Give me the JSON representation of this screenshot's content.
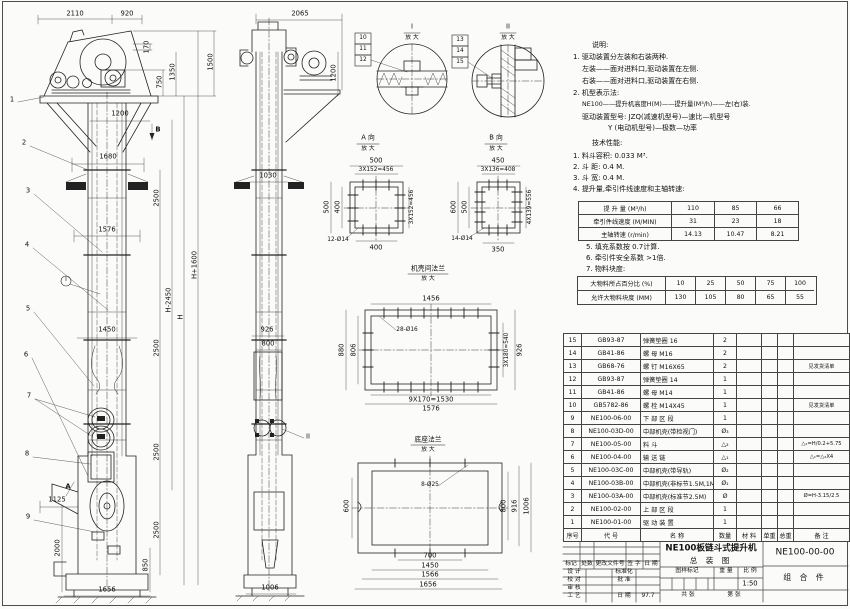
{
  "notes": {
    "heading": "说明:",
    "lines": [
      "1. 驱动装置分左装和右装两种.",
      "左装——面对进料口,驱动装置在左侧.",
      "右装——面对进料口,驱动装置在右侧.",
      "2. 机型表示法:",
      "NE100——提升机高度H(M)——提升量(M³/h)——左(右)装.",
      "驱动装置型号: JZQ(减速机型号)—速比—机型号",
      "Y (电动机型号)—极数—功率"
    ]
  },
  "tech": {
    "heading": "技术性能:",
    "items": [
      "1. 料斗容积: 0.033 M³.",
      "2. 斗  距: 0.4 M.",
      "3. 斗  宽: 0.4 M.",
      "4. 提升量,牵引件线速度和主轴转速:"
    ],
    "items2": [
      "5. 填充系数按 0.7计算.",
      "6. 牵引件安全系数 >1倍.",
      "7. 物料块度:"
    ]
  },
  "spec": {
    "rows": [
      {
        "label": "提 升 量 (M³/h)",
        "v1": "110",
        "v2": "85",
        "v3": "66"
      },
      {
        "label": "牵引件线速度 (M/MIN)",
        "v1": "31",
        "v2": "23",
        "v3": "18"
      },
      {
        "label": "主轴转速 (r/min)",
        "v1": "14.13",
        "v2": "10.47",
        "v3": "8.21"
      }
    ]
  },
  "lump": {
    "rows": [
      {
        "label": "大物料所占百分比 (%)",
        "c1": "10",
        "c2": "25",
        "c3": "50",
        "c4": "75",
        "c5": "100"
      },
      {
        "label": "允许大物料块度 (MM)",
        "c1": "130",
        "c2": "105",
        "c3": "80",
        "c4": "65",
        "c5": "55"
      }
    ]
  },
  "bom": {
    "headers": [
      "序号",
      "代  号",
      "名  称",
      "数量",
      "材  料",
      "单重",
      "总重",
      "备  注"
    ],
    "rows": [
      {
        "no": "15",
        "code": "GB93-87",
        "name": "弹簧垫圈 16",
        "qty": "2",
        "rem": ""
      },
      {
        "no": "14",
        "code": "GB41-86",
        "name": "螺 母 M16",
        "qty": "2",
        "rem": ""
      },
      {
        "no": "13",
        "code": "GB68-76",
        "name": "螺 钉 M16X65",
        "qty": "2",
        "rem": "见发货清单"
      },
      {
        "no": "12",
        "code": "GB93-87",
        "name": "弹簧垫圈 14",
        "qty": "1",
        "rem": ""
      },
      {
        "no": "11",
        "code": "GB41-86",
        "name": "螺 母 M14",
        "qty": "1",
        "rem": ""
      },
      {
        "no": "10",
        "code": "GB5782-86",
        "name": "螺 栓 M14X45",
        "qty": "1",
        "rem": "见发货清单"
      },
      {
        "no": "9",
        "code": "NE100-06-00",
        "name": "下 部 区 段",
        "qty": "1",
        "rem": ""
      },
      {
        "no": "8",
        "code": "NE100-03D-00",
        "name": "中部机壳(带检视门)",
        "qty": "Ø₃",
        "rem": ""
      },
      {
        "no": "7",
        "code": "NE100-05-00",
        "name": "料 斗",
        "qty": "△₂",
        "rem": "△₂=H/0.2+5.75"
      },
      {
        "no": "6",
        "code": "NE100-04-00",
        "name": "输 送 链",
        "qty": "△₁",
        "rem": "△₁=△₂X4"
      },
      {
        "no": "5",
        "code": "NE100-03C-00",
        "name": "中部机壳(带导轨)",
        "qty": "Ø₂",
        "rem": ""
      },
      {
        "no": "4",
        "code": "NE100-03B-00",
        "name": "中部机壳(非标节1.5M,1M)",
        "qty": "Ø₁",
        "rem": ""
      },
      {
        "no": "3",
        "code": "NE100-03A-00",
        "name": "中部机壳(标准节2.5M)",
        "qty": "Ø",
        "rem": "Ø=H-3.15/2.5"
      },
      {
        "no": "2",
        "code": "NE100-02-00",
        "name": "上 部 区 段",
        "qty": "1",
        "rem": ""
      },
      {
        "no": "1",
        "code": "NE100-01-00",
        "name": "驱 动 装 置",
        "qty": "1",
        "rem": ""
      }
    ]
  },
  "tb": {
    "title1": "NE100板链斗式提升机",
    "title2": "总  装  图",
    "dwg_no": "NE100-00-00",
    "part": "组 合 件",
    "rev": [
      "标记",
      "处数",
      "更改文件号",
      "签 字",
      "日 期"
    ],
    "design": "设 计",
    "std": "标准化",
    "check": "校 对",
    "approve": "批 准",
    "audit": "审 核",
    "craft": "工 艺",
    "date_lbl": "日 期",
    "date": "97.7",
    "mark": "图样标记",
    "weight": "重 量",
    "scale_lbl": "比 例",
    "scale": "1:50",
    "sheets": "共  张",
    "page": "第  张"
  },
  "fv": {
    "d2110": "2110",
    "d920": "920",
    "d170": "170",
    "d750": "750",
    "d1350": "1350",
    "d1500": "1500",
    "d1200": "1200",
    "d1680": "1680",
    "d1576": "1576",
    "d1450": "1450",
    "d1125": "1125",
    "d2000": "2000",
    "d850": "850",
    "d1656": "1656",
    "d2500a": "2500",
    "d2500b": "2500",
    "d2500c": "2500",
    "d2500d": "2500",
    "dH1600": "H+1600",
    "dH2450": "H-2450",
    "dH": "H",
    "mA": "A",
    "mB": "B",
    "mI": "I"
  },
  "sv": {
    "d2065": "2065",
    "d1200": "1200",
    "d1030": "1030",
    "d926": "926",
    "d800": "800",
    "d1006": "1006",
    "mII": "II"
  },
  "co": {
    "c1": "1",
    "c2": "2",
    "c3": "3",
    "c4": "4",
    "c5": "5",
    "c6": "6",
    "c7": "7",
    "c8": "8",
    "c9": "9"
  },
  "di": {
    "title": "I",
    "sub": "放 大",
    "c10": "10",
    "c11": "11",
    "c12": "12"
  },
  "dii": {
    "title": "II",
    "sub": "放 大",
    "c13": "13",
    "c14": "14",
    "c15": "15"
  },
  "da": {
    "title": "A 向",
    "sub": "放 大",
    "t1": "500",
    "t2": "3X152=456",
    "l1": "500",
    "l2": "400",
    "r1": "3X152=456",
    "b1": "400",
    "holes": "12-Ø14"
  },
  "db": {
    "title": "B 向",
    "sub": "放 大",
    "t1": "450",
    "t2": "3X136=408",
    "l1": "600",
    "l2": "500",
    "r1": "4X139=556",
    "b1": "350",
    "holes": "14-Ø14"
  },
  "df": {
    "title": "机壳间法兰",
    "sub": "放 大",
    "t1": "1456",
    "l1": "880",
    "l2": "806",
    "holes": "28-Ø16",
    "r1": "3X180=540",
    "r2": "926",
    "b1": "9X170=1530",
    "b2": "1576"
  },
  "dg": {
    "title": "底座法兰",
    "sub": "放 大",
    "holes": "8-Ø25",
    "l1": "600",
    "r1": "800",
    "r2": "916",
    "r3": "1006",
    "b1": "700",
    "b2": "1450",
    "b3": "1566",
    "b4": "1656"
  }
}
